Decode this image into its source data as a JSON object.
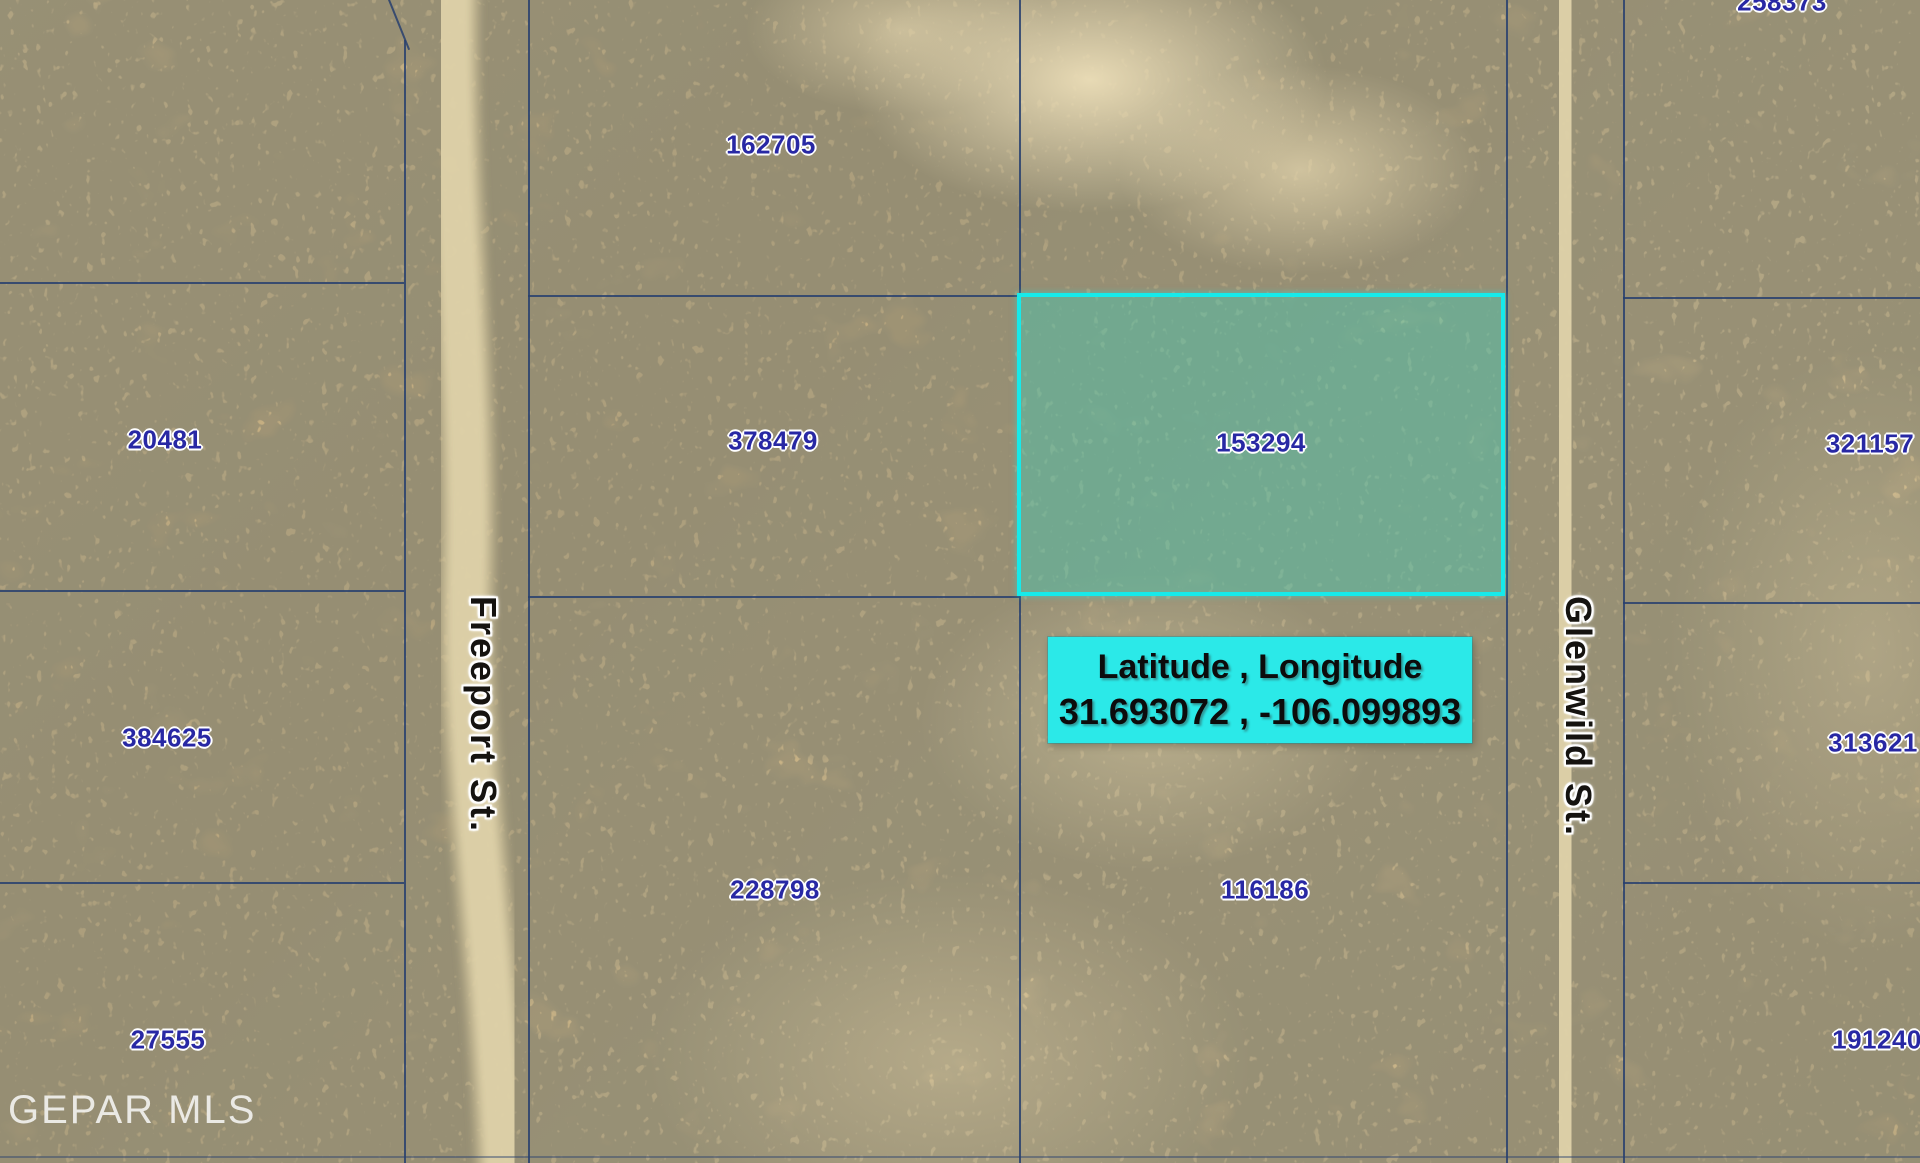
{
  "map": {
    "watermark": "GEPAR MLS",
    "coordinate_label": {
      "line1": "Latitude , Longitude",
      "line2": "31.693072 , -106.099893"
    },
    "highlighted_parcel": {
      "id": "153294",
      "region": {
        "x": 1017,
        "y": 293,
        "w": 488,
        "h": 303
      }
    },
    "streets": [
      {
        "name": "Freeport St.",
        "x": 483,
        "y": 596
      },
      {
        "name": "Glenwild St.",
        "x": 1578,
        "y": 596
      }
    ],
    "parcels": [
      {
        "id": "258373",
        "x": 1782,
        "y": 2
      },
      {
        "id": "162705",
        "x": 771,
        "y": 145
      },
      {
        "id": "20481",
        "x": 165,
        "y": 440
      },
      {
        "id": "378479",
        "x": 773,
        "y": 441
      },
      {
        "id": "153294",
        "x": 1261,
        "y": 443,
        "highlighted": true
      },
      {
        "id": "321157",
        "x": 1870,
        "y": 444
      },
      {
        "id": "384625",
        "x": 167,
        "y": 738
      },
      {
        "id": "313621",
        "x": 1873,
        "y": 743
      },
      {
        "id": "228798",
        "x": 775,
        "y": 890
      },
      {
        "id": "116186",
        "x": 1265,
        "y": 890
      },
      {
        "id": "27555",
        "x": 168,
        "y": 1040
      },
      {
        "id": "191240",
        "x": 1877,
        "y": 1040
      }
    ],
    "boundary_lines": [
      {
        "x": 404,
        "y": 40,
        "w": 2,
        "h": 1123
      },
      {
        "x": 388,
        "y": 0,
        "w": 2,
        "h": 54,
        "angle": -22
      },
      {
        "x": 528,
        "y": 0,
        "w": 2,
        "h": 1163
      },
      {
        "x": 1019,
        "y": 0,
        "w": 2,
        "h": 1163
      },
      {
        "x": 1506,
        "y": 0,
        "w": 2,
        "h": 1163
      },
      {
        "x": 1623,
        "y": 0,
        "w": 2,
        "h": 1163
      },
      {
        "x": 0,
        "y": 282,
        "w": 404,
        "h": 2
      },
      {
        "x": 0,
        "y": 590,
        "w": 404,
        "h": 2
      },
      {
        "x": 0,
        "y": 882,
        "w": 404,
        "h": 2
      },
      {
        "x": 528,
        "y": 295,
        "w": 493,
        "h": 2
      },
      {
        "x": 528,
        "y": 596,
        "w": 493,
        "h": 2
      },
      {
        "x": 1623,
        "y": 297,
        "w": 297,
        "h": 2
      },
      {
        "x": 1623,
        "y": 602,
        "w": 297,
        "h": 2
      },
      {
        "x": 1623,
        "y": 882,
        "w": 297,
        "h": 2
      },
      {
        "x": 0,
        "y": 1156,
        "w": 1920,
        "h": 2,
        "faint": true
      }
    ],
    "colors": {
      "parcel_number": "#2828a4",
      "boundary_line": "#27406e",
      "highlight_cyan": "#16EAEA",
      "label_background": "#2BE9E8",
      "street_text": "#151310"
    }
  }
}
